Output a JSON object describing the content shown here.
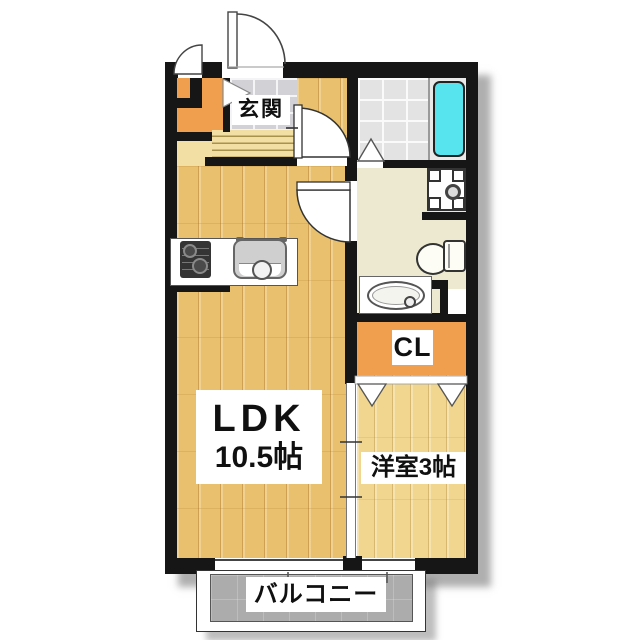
{
  "floorplan": {
    "type": "japanese-apartment-floorplan",
    "rooms": {
      "entrance": {
        "label": "玄関"
      },
      "ldk": {
        "name": "LDK",
        "size": "10.5帖"
      },
      "western_room": {
        "label": "洋室3帖"
      },
      "closet": {
        "label": "CL"
      },
      "balcony": {
        "label": "バルコニー"
      }
    },
    "fixtures": [
      "entrance-door",
      "storage-door",
      "shoe-closet-door",
      "kitchen-stove",
      "kitchen-sink",
      "bathroom-folding-door",
      "bathtub",
      "washing-machine-pan",
      "toilet",
      "washbasin",
      "closet-bifold-doors",
      "room-partition-sliding-door",
      "ldk-window",
      "western-room-window"
    ],
    "colors": {
      "wall": "#161616",
      "ldk_wood": "#E9C16E",
      "west_wood": "#F1D68F",
      "closet_orange": "#EF9F4D",
      "step_cream": "#F1DFA3",
      "genkan_tile": "#D2D2D6",
      "bath_tile": "#E3E3E3",
      "sanitary_beige": "#ECE9D0",
      "tub_cyan": "#58E4EF",
      "balcony_gray": "#ACACAC"
    }
  }
}
